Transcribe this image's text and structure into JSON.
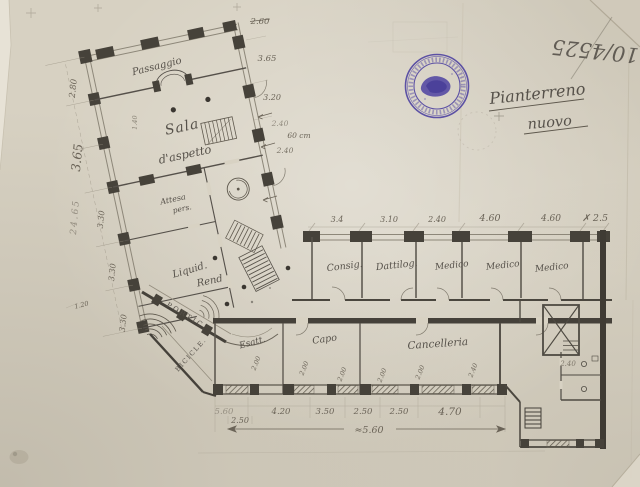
{
  "sheet": {
    "registry_number": "10/4525",
    "title": "Pianterreno",
    "subtitle": "nuovo",
    "stamp": {
      "ink": "#4b3fa0",
      "note": "circular violet ink stamp, legend illegible"
    }
  },
  "left_wing": {
    "rooms": {
      "passaggio": "Passaggio",
      "sala_1": "Sala",
      "sala_2": "d'aspetto",
      "attesa_1": "Attesa",
      "attesa_2": "pers.",
      "liquid_1": "Liquid.",
      "liquid_2": "Rend"
    },
    "dims_left": [
      "2.80",
      "3.65",
      "3.30",
      "3.30",
      "3.30"
    ],
    "dim_overall": "24.65",
    "dim_inner": "1.40",
    "dim_small": "1.20",
    "dims_right": [
      "2.60",
      "3.65",
      "3.20",
      "2.40",
      "60 cm",
      "2.40"
    ]
  },
  "portico": {
    "label": "PORTIC.",
    "bicycles": "BICICLE."
  },
  "right_wing": {
    "dims_top": [
      "3.4",
      "3.10",
      "2.40",
      "4.60",
      "4.60",
      "✗ 2.5"
    ],
    "rooms_top": [
      "Consig.",
      "Dattilog.",
      "Medico",
      "Medico",
      "Medico"
    ],
    "rooms_bottom": [
      "Esatt.",
      "Capo",
      "Cancelleria"
    ],
    "dims_windows": [
      "2.00",
      "2.00",
      "2.00",
      "2.00",
      "2.00",
      "2.40"
    ],
    "dims_bottom": [
      "5.60",
      "4.20",
      "3.50",
      "2.50",
      "2.50",
      "4.70"
    ],
    "dim_sub": "2.50",
    "dim_span": "≈5.60",
    "dim_right": "2.40"
  }
}
